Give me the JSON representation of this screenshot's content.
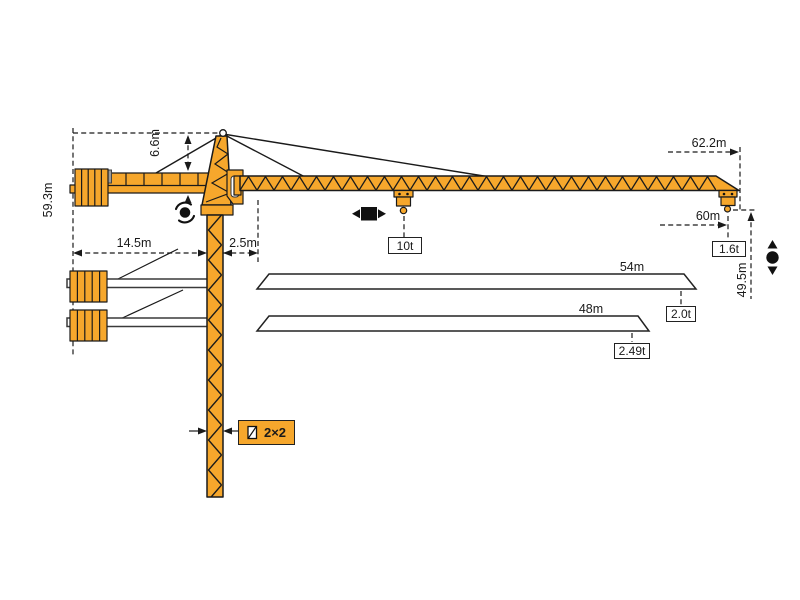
{
  "colors": {
    "crane": "#F6A72C",
    "ink": "#1a1a1a"
  },
  "labels": {
    "total_height": "59.3m",
    "tower_head_height": "6.6m",
    "counter_jib_length": "14.5m",
    "rear_clearance": "2.5m",
    "max_radius_overall": "62.2m",
    "max_radius_hook": "60m",
    "hook_height": "49.5m",
    "jib_option_1": "54m",
    "jib_option_2": "48m",
    "max_load": "10t",
    "tip_load_62m": "1.6t",
    "tip_load_54m": "2.0t",
    "tip_load_48m": "2.49t",
    "mast_section": "2×2"
  },
  "icons": {
    "slewing": "slewing-rotation-icon",
    "trolley": "trolley-travel-icon",
    "hoist": "hook-hoist-icon",
    "mast_section": "mast-cross-section-icon"
  }
}
